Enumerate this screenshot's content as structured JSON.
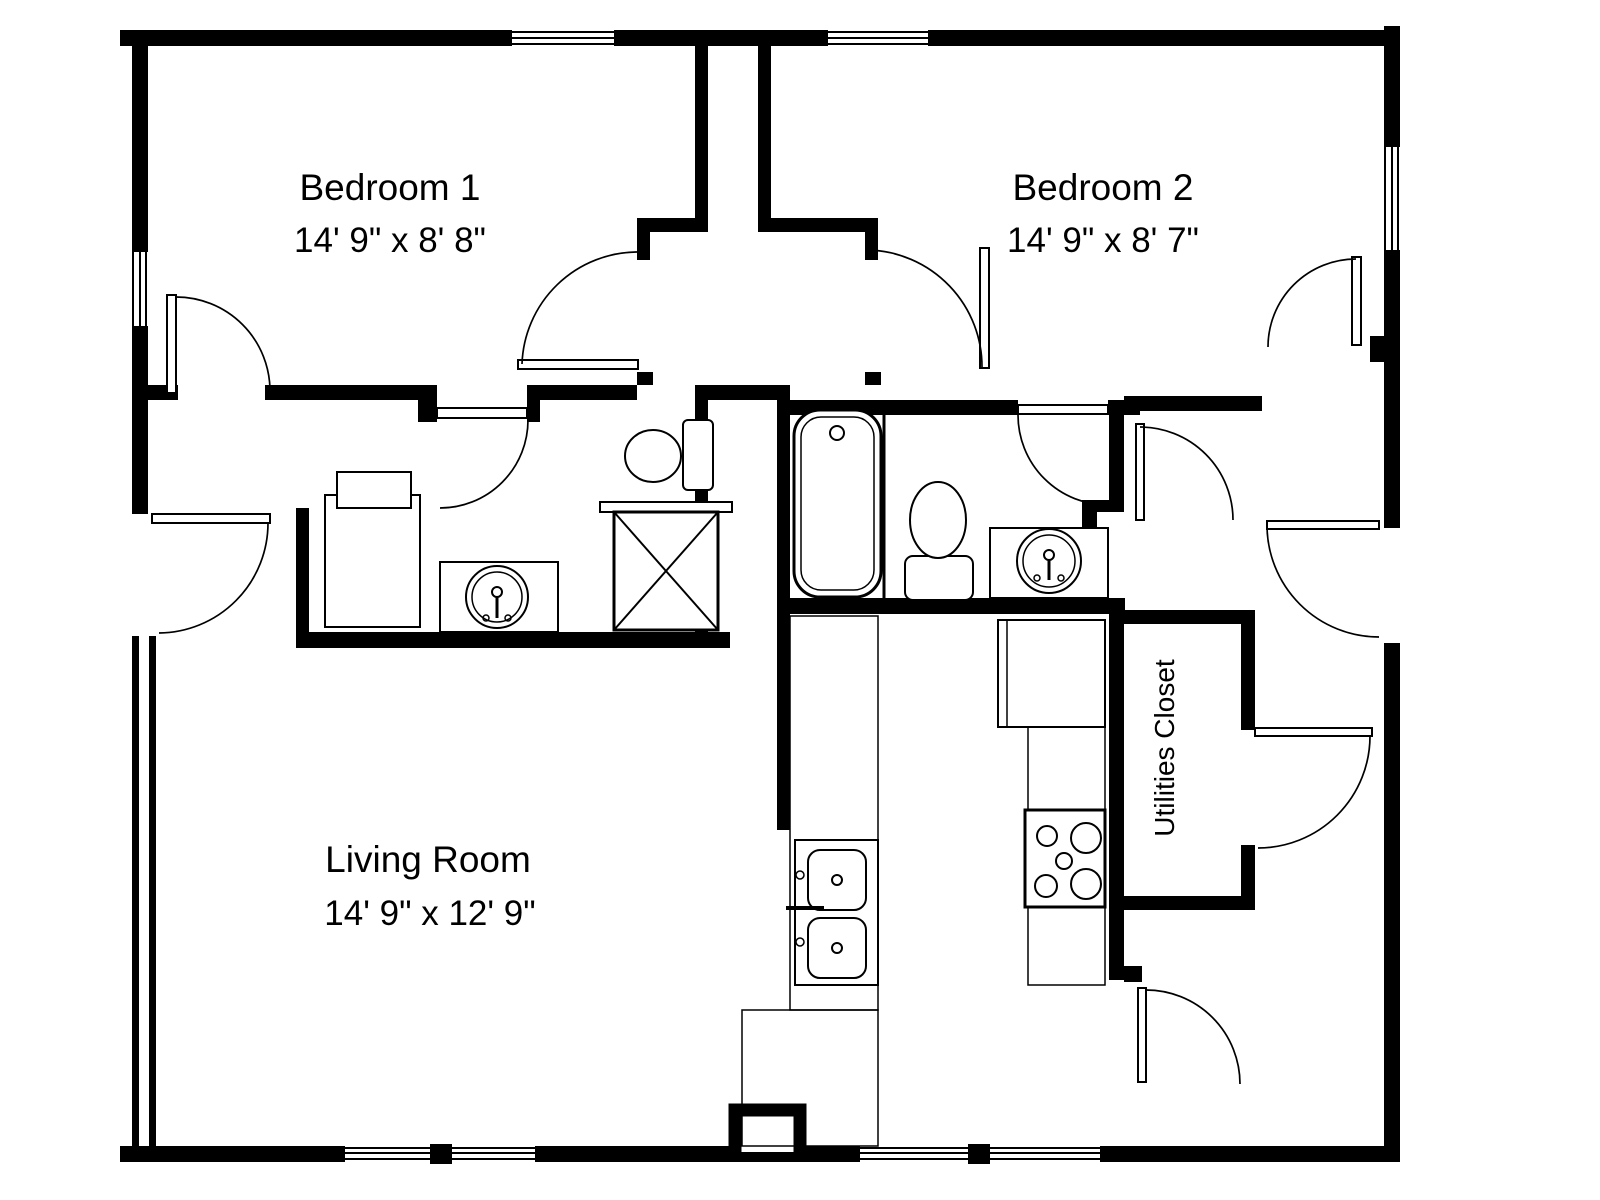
{
  "plan": {
    "colors": {
      "wall": "#000000",
      "background": "#ffffff",
      "fixture_outline": "#000000"
    },
    "rooms": {
      "bedroom1": {
        "name": "Bedroom 1",
        "dimensions": "14' 9\" x 8' 8\""
      },
      "bedroom2": {
        "name": "Bedroom 2",
        "dimensions": "14' 9\" x 8' 7\""
      },
      "living_room": {
        "name": "Living Room",
        "dimensions": "14' 9\" x 12' 9\""
      },
      "utilities_closet": {
        "name": "Utilities Closet"
      }
    },
    "fixtures": [
      {
        "icon": "washer-icon",
        "room": "bathroom-1"
      },
      {
        "icon": "sink-icon",
        "room": "bathroom-1"
      },
      {
        "icon": "toilet-icon",
        "room": "bathroom-1"
      },
      {
        "icon": "shower-icon",
        "room": "bathroom-1"
      },
      {
        "icon": "bathtub-icon",
        "room": "bathroom-2"
      },
      {
        "icon": "toilet-icon",
        "room": "bathroom-2"
      },
      {
        "icon": "sink-icon",
        "room": "bathroom-2"
      },
      {
        "icon": "kitchen-sink-icon",
        "room": "kitchen"
      },
      {
        "icon": "fridge-icon",
        "room": "kitchen"
      },
      {
        "icon": "stove-icon",
        "room": "kitchen"
      }
    ]
  }
}
